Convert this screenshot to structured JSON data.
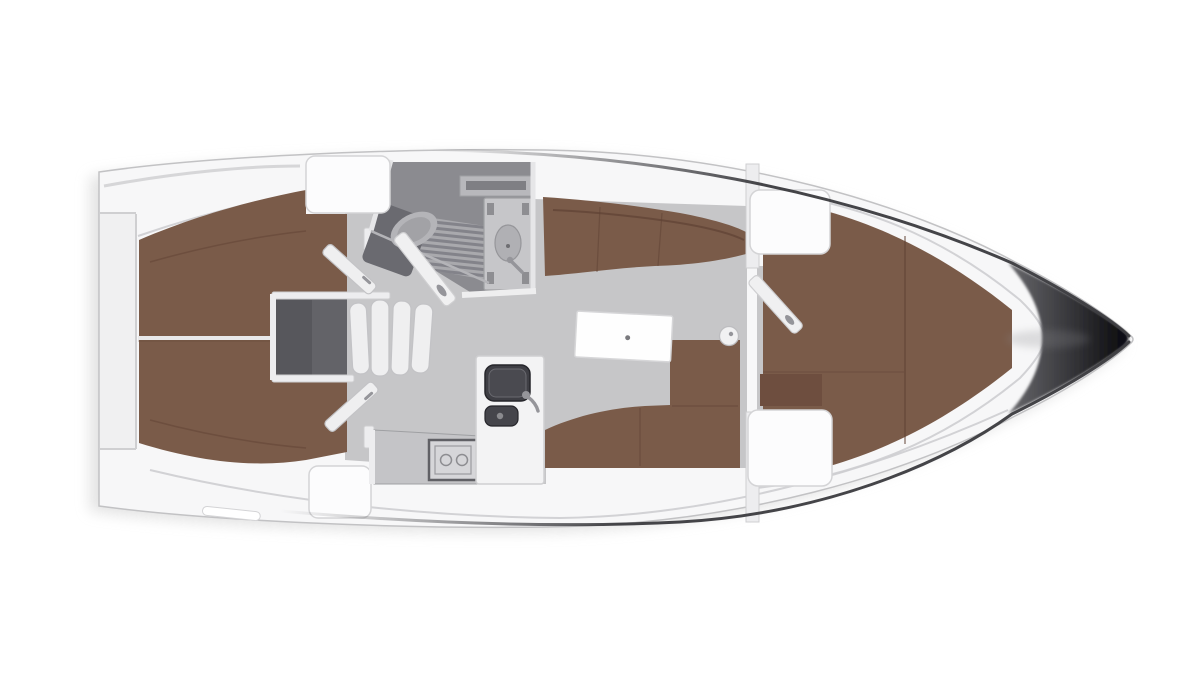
{
  "document": {
    "type": "yacht-interior-floorplan",
    "orientation": "bow-right",
    "visible_text": []
  },
  "palette": {
    "bg": "#ffffff",
    "shadow": "#dedede",
    "hull": "#f7f7f8",
    "hullStroke": "#c2c2c4",
    "gunwale": "#3b3b3f",
    "deckLine": "#cdcdd0",
    "transomShade": "#f0f0f1",
    "floor": "#c6c6c8",
    "floorDark": "#8b8b90",
    "brown": "#7a5b49",
    "brownDark": "#6e4e3f",
    "brownSeam": "#5f4234",
    "boxDark": "#57575c",
    "wallWhite": "#ededef",
    "wallStroke": "#cfcfd1",
    "blockWhite": "#fcfcfd",
    "blockStroke": "#d4d4d6",
    "metal": "#95959a",
    "sinkDark": "#3f3f45",
    "sinkDarker": "#26262b",
    "sinkInner": "#4a4a50",
    "grateDark": "#83838a",
    "grateLight": "#a9a9ad",
    "fixtureGray": "#c6c6c9",
    "fixtureStroke": "#9fa0a3",
    "seatGray": "#b4b4b8",
    "consoleGray": "#6a6a70",
    "tableWhite": "#fefefe",
    "tableStroke": "#d6d6d8",
    "stepWhite": "#efeff0",
    "stepStroke": "#c3c3c6",
    "bowLight": "#6b6b6f",
    "bowMid": "#3a3a3e",
    "bowDark": "#101013",
    "counterGray": "#c4c4c7",
    "stoveFrame": "#606065",
    "shelfGray": "#b8b8bc",
    "shelfSlot": "#7f7f84"
  },
  "components": {
    "hull": "hull-and-deck",
    "bow": "bow-tip",
    "stern": "transom",
    "aft_cabins": "two-aft-double-berths",
    "companionway": "companionway-steps-and-engine-box",
    "head": "bathroom-with-toilet-shower-sink",
    "galley": "galley-with-sink-and-stove",
    "salon": "salon-with-table-and-settees",
    "forward_cabin": "v-berth-cabin"
  }
}
